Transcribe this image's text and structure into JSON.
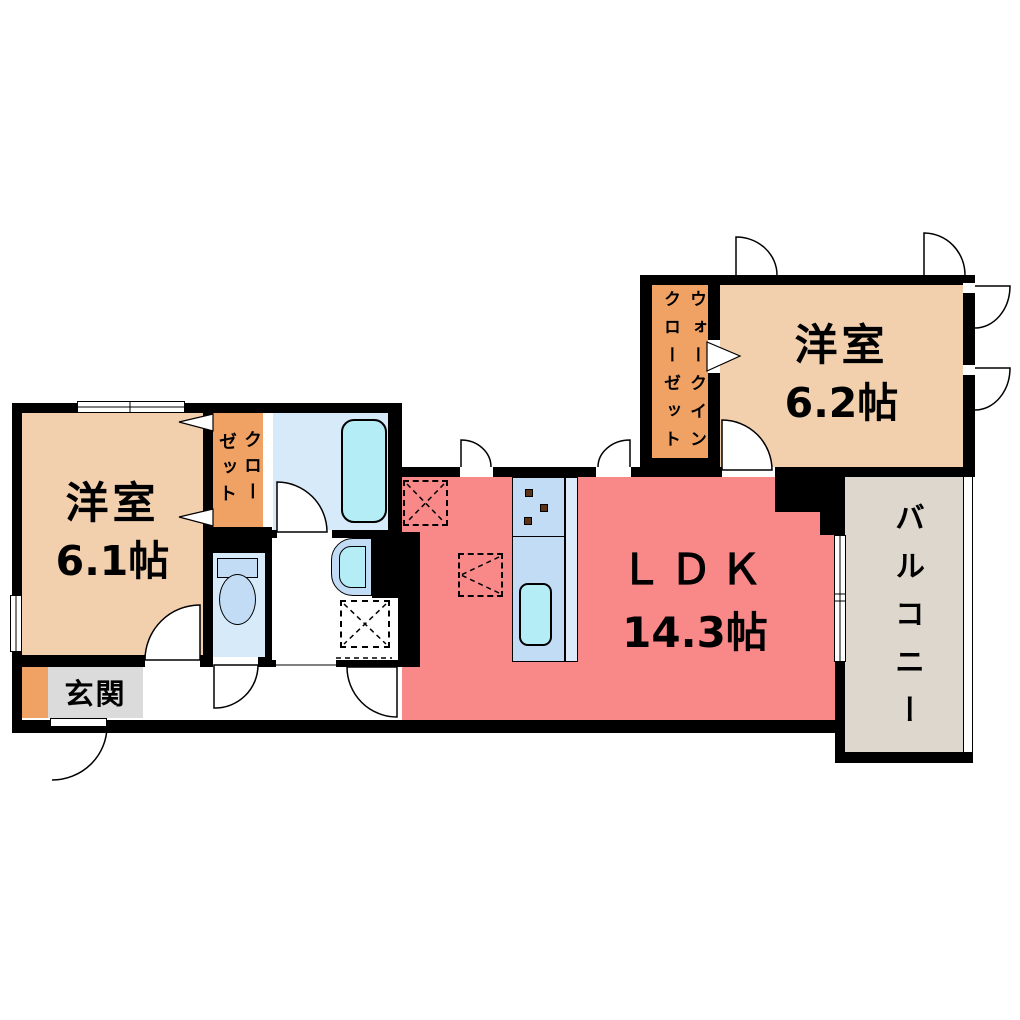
{
  "rooms": {
    "western_room_1": {
      "name": "洋室",
      "size": "6.1帖"
    },
    "western_room_2": {
      "name": "洋室",
      "size": "6.2帖"
    },
    "ldk": {
      "name": "ＬＤＫ",
      "size": "14.3帖"
    },
    "entrance": {
      "name": "玄関"
    },
    "balcony": {
      "name": "バルコニー"
    },
    "closet": {
      "name": "クローゼット",
      "column_right": "クロー",
      "column_left": "ゼット"
    },
    "walk_in_closet": {
      "name": "ウォークインクローゼット",
      "column_right": "ウォークイン",
      "column_left": "クローゼット"
    }
  },
  "colors": {
    "ldk": "#F98989",
    "room": "#F2D0AE",
    "storage": "#F0A265",
    "water": "#D6EAFA",
    "fixture": "#C3DCF6",
    "basin": "#B4EDF5",
    "counterlip": "#DCEBFB",
    "genkan": "#DBDBDB",
    "balcony": "#DDD7CD",
    "burner": "#5C3317",
    "wall": "#000000"
  }
}
